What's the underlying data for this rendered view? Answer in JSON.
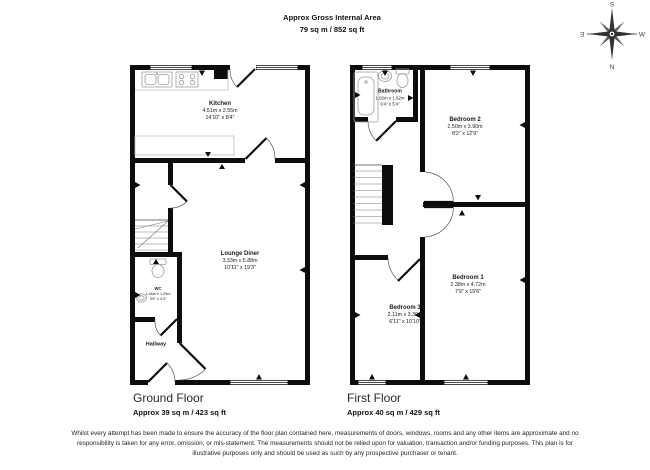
{
  "header": {
    "line1": "Approx Gross Internal Area",
    "line2": "79 sq m / 852 sq ft"
  },
  "compass": {
    "north": "N",
    "south": "S",
    "east": "E",
    "west": "W"
  },
  "ground": {
    "title": "Ground Floor",
    "area": "Approx 39 sq m / 423 sq ft",
    "kitchen": {
      "name": "Kitchen",
      "metric": "4.51m x 2.55m",
      "imperial": "14'10\" x 8'4\""
    },
    "lounge": {
      "name": "Lounge Diner",
      "metric": "3.33m x 5.88m",
      "imperial": "10'11\" x 19'3\""
    },
    "wc": {
      "name": "WC",
      "metric": "1.06m x 1.29m",
      "imperial": "3'6\" x 4'3\""
    },
    "hallway": {
      "name": "Hallway"
    }
  },
  "first": {
    "title": "First Floor",
    "area": "Approx 40 sq m / 429 sq ft",
    "bathroom": {
      "name": "Bathroom",
      "metric": "1.92m x 1.62m",
      "imperial": "6'4\" x 5'4\""
    },
    "bedroom2": {
      "name": "Bedroom 2",
      "metric": "2.50m x 3.90m",
      "imperial": "8'2\" x 12'9\""
    },
    "bedroom1": {
      "name": "Bedroom 1",
      "metric": "2.38m x 4.72m",
      "imperial": "7'9\" x 15'6\""
    },
    "bedroom3": {
      "name": "Bedroom 3",
      "metric": "2.11m x 3.30m",
      "imperial": "6'11\" x 10'10\""
    }
  },
  "disclaimer": {
    "text": "Whilst every attempt has been made to ensure the accuracy of the floor plan contained here, measurements of doors, windows, rooms and any other items are approximate and no responsibility is taken for any error, omission, or mis-statement. The measurements should not be relied upon for valuation, transaction and/or funding purposes. This plan is for illustrative purposes only and should be used as such by any prospective purchaser or tenant."
  }
}
